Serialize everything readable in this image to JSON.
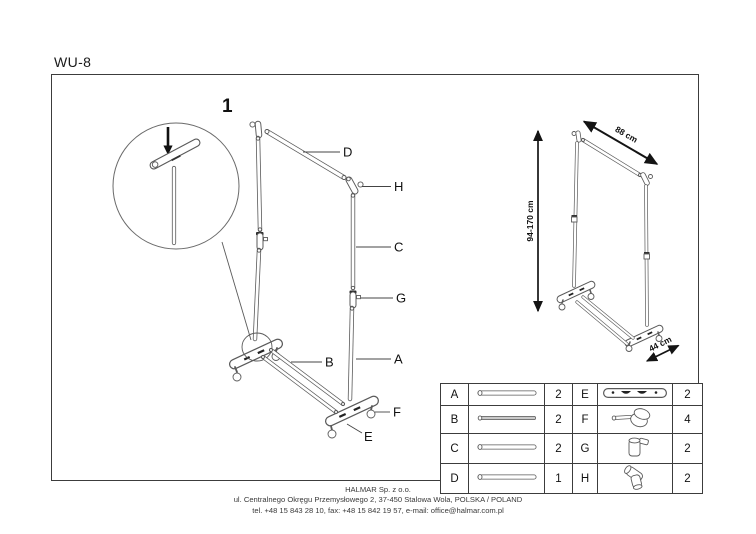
{
  "title": "WU-8",
  "step": "1",
  "callouts": {
    "A": "A",
    "B": "B",
    "C": "C",
    "D": "D",
    "E": "E",
    "F": "F",
    "G": "G",
    "H": "H"
  },
  "dimensions": {
    "width": "88 cm",
    "height": "94-170 cm",
    "depth": "44 cm"
  },
  "parts_table": {
    "rows": [
      {
        "l_letter": "A",
        "l_icon": "tube-long-icon",
        "l_qty": "2",
        "r_letter": "E",
        "r_icon": "base-foot-icon",
        "r_qty": "2"
      },
      {
        "l_letter": "B",
        "l_icon": "tube-thin-icon",
        "l_qty": "2",
        "r_letter": "F",
        "r_icon": "caster-wheel-icon",
        "r_qty": "4"
      },
      {
        "l_letter": "C",
        "l_icon": "tube-long-icon",
        "l_qty": "2",
        "r_letter": "G",
        "r_icon": "clamp-connector-icon",
        "r_qty": "2"
      },
      {
        "l_letter": "D",
        "l_icon": "tube-long-icon",
        "l_qty": "1",
        "r_letter": "H",
        "r_icon": "corner-connector-icon",
        "r_qty": "2"
      }
    ]
  },
  "footer": {
    "company": "HALMAR Sp. z o.o.",
    "address": "ul. Centralnego Okręgu Przemysłowego 2, 37-450 Stalowa Wola, POLSKA / POLAND",
    "contact": "tel. +48 15 843 28 10, fax: +48 15 842 19 57, e-mail: office@halmar.com.pl"
  }
}
